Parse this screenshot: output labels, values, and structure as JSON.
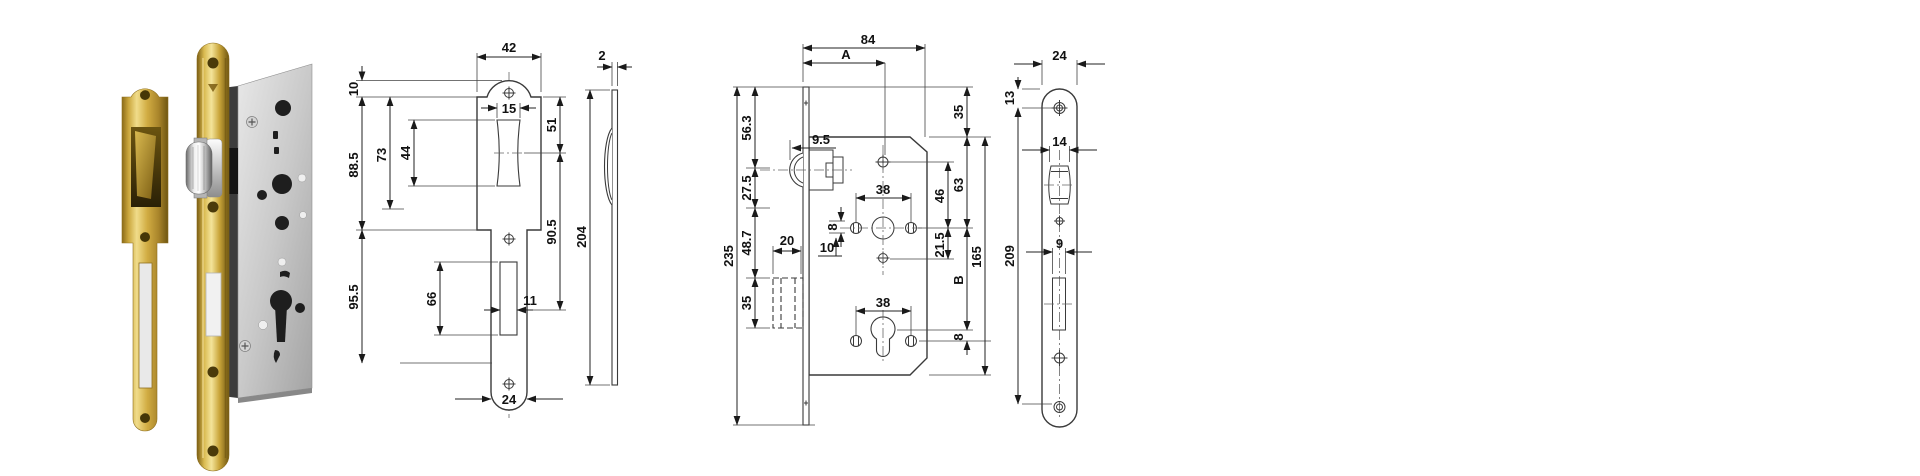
{
  "page": {
    "background": "#ffffff"
  },
  "photo": {
    "left_part": "brass strike plate",
    "right_part": "mortise lock with brass forend and roller latch",
    "colors": {
      "brass": "#c9a53a",
      "brass_highlight": "#f0dc8a",
      "brass_shadow": "#6e5510",
      "steel_case": "#c6c6c6",
      "chrome_roller": "#e9e9e9",
      "hole_dark": "#1e1e1e"
    }
  },
  "drawings": {
    "line_color": "#222222",
    "strike_front": {
      "top_width": "42",
      "tab_height": "10",
      "cutout_width": "15",
      "upper_height": "88.5",
      "dustbox_height": "73",
      "cutout_height": "44",
      "top_to_cutout_centre": "51",
      "cutout_to_slot_centre": "90.5",
      "lower_height": "95.5",
      "slot_height": "66",
      "slot_width": "11",
      "bottom_width": "24"
    },
    "strike_side": {
      "thickness": "2",
      "height": "204"
    },
    "lock_case": {
      "case_depth": "84",
      "backset": "A",
      "top_to_latch": "56.3",
      "latch_pitch": "27.5",
      "follower_pitch": "48.7",
      "deadbolt_height": "35",
      "forend_height": "235",
      "latch_projection": "9.5",
      "deadbolt_throw": "20",
      "offset_ten": "10",
      "spindle_square": "8",
      "screw_span_upper": "38",
      "screw_span_lower": "38",
      "forend_to_case_top": "35",
      "case_top_to_follower": "63",
      "hole_pitch": "46",
      "follower_to_hole": "21.5",
      "centres": "B",
      "cylinder_offset": "8",
      "case_height": "165"
    },
    "forend_front": {
      "width": "24",
      "top_to_screw": "13",
      "screw_centres": "209",
      "latch_width": "14",
      "deadbolt_width": "9"
    }
  }
}
